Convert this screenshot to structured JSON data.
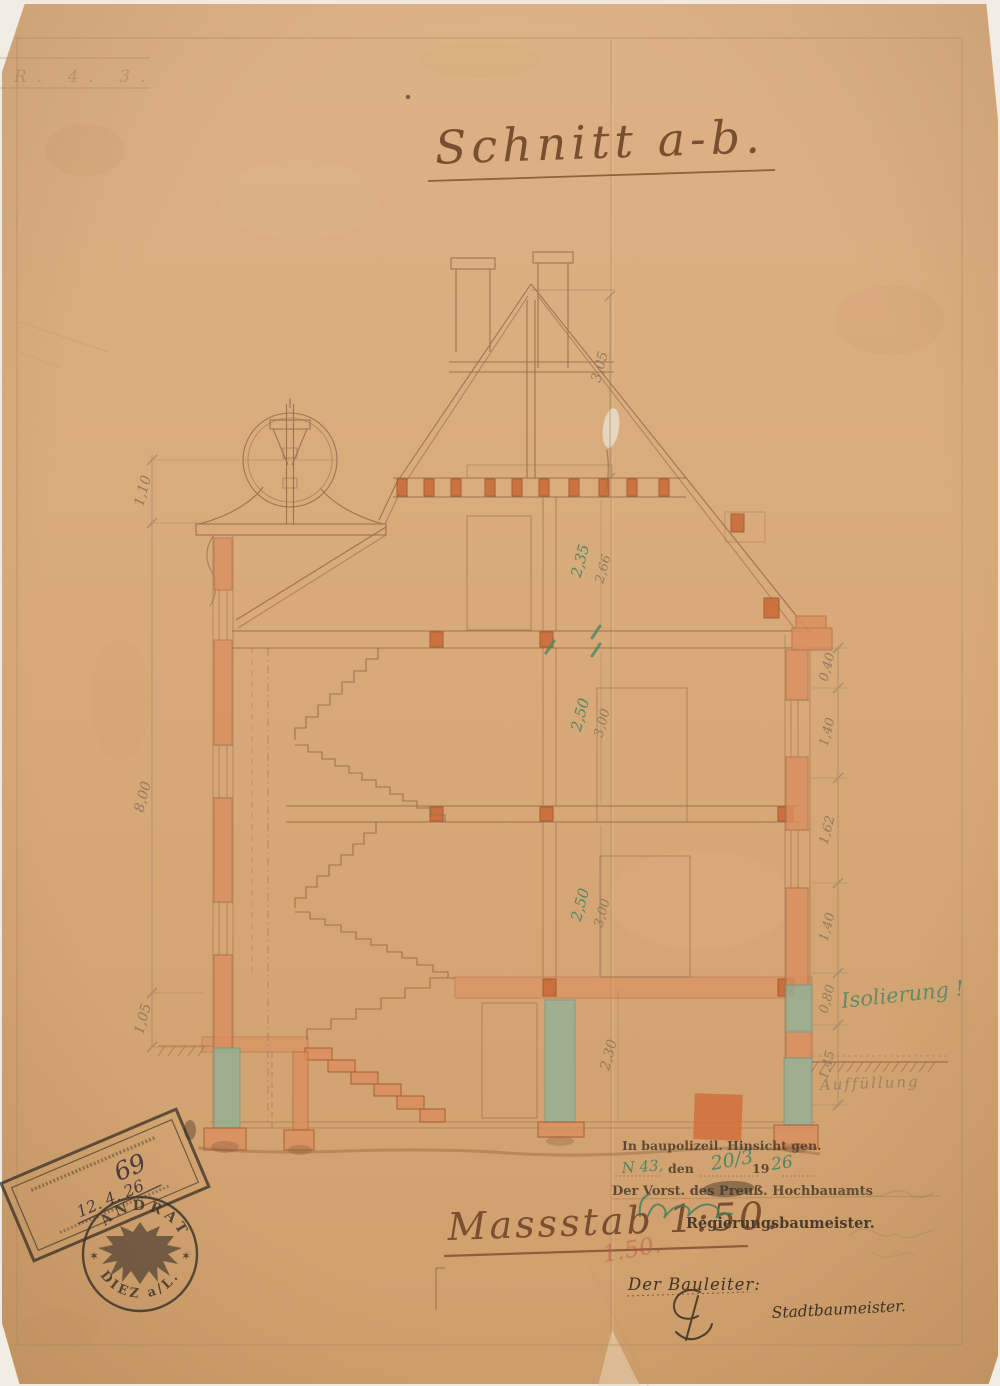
{
  "sheet": {
    "corner_note": "R.  4.  3.",
    "title": "Schnitt a-b.",
    "scale": "Massstab 1:50.",
    "scale_red": "1:50."
  },
  "drawing_labels": {
    "insulation_note": "Isolierung !",
    "fill_note": "Auffüllung"
  },
  "dimensions": {
    "left_chain": [
      "1,10",
      "8,00",
      "1,05"
    ],
    "right_chain": [
      "0,40",
      "1,40",
      "1,62",
      "1,40",
      "0,80",
      "1,45"
    ],
    "roof_height": "3,05",
    "attic_room": "2,35",
    "attic_total": "2,66",
    "second_room": "2,50",
    "second_total": "3,00",
    "first_room": "2,50",
    "first_total": "3,00",
    "basement_height": "2,30"
  },
  "approval_block": {
    "line1": "In baupolizeil. Hinsicht gen.",
    "hand_ref": "N 43,",
    "word_den": "den",
    "hand_date": "20/3",
    "word_year": "19",
    "hand_year": "26",
    "line2": "Der Vorst. des Preuß. Hochbauamts",
    "title": "Regierungsbaumeister."
  },
  "builder_block": {
    "label": "Der Bauleiter:",
    "title": "Stadtbaumeister."
  },
  "stamps": {
    "rect_number": "69",
    "rect_date": "12. 4. 26",
    "round_top": "LANDRAT",
    "round_bottom": "DIEZ a/L.",
    "star_left": "✶",
    "star_right": "✶"
  }
}
